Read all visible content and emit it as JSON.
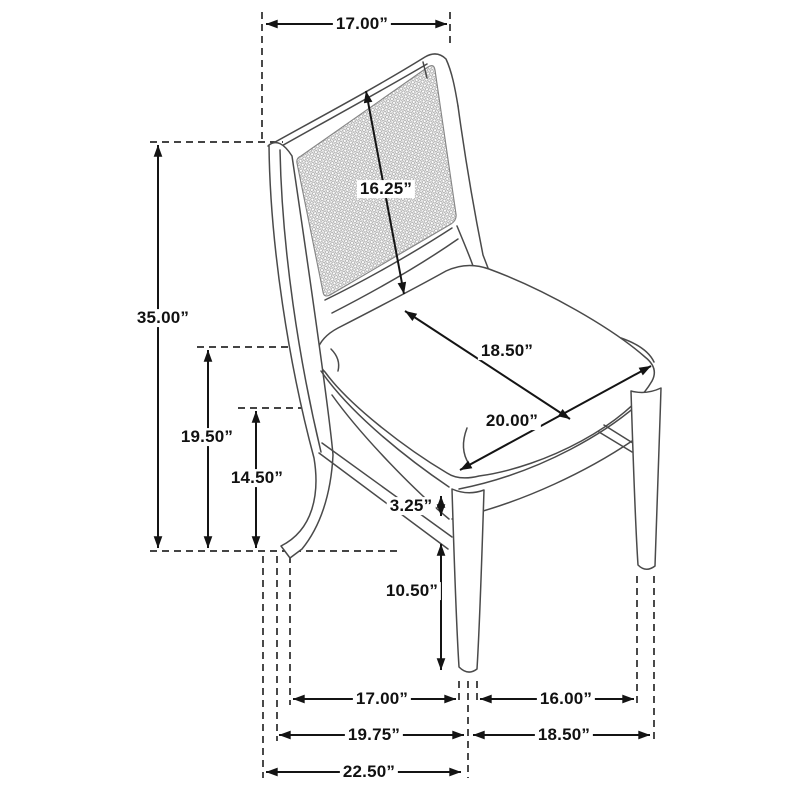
{
  "diagram": {
    "unit": "inches",
    "colors": {
      "dimension_line": "#141414",
      "chair_line": "#4a4a4a",
      "cane_mesh": "#8f8f8f",
      "background": "#ffffff"
    },
    "dims": {
      "back_width": "17.00”",
      "overall_height": "35.00”",
      "back_panel_height": "16.25”",
      "seat_depth": "18.50”",
      "seat_width": "20.00”",
      "seat_height": "19.50”",
      "frame_height": "14.50”",
      "seat_rail_thickness": "3.25”",
      "leg_height": "10.50”",
      "leg_span_side": "17.00”",
      "front_leg_inner_width": "16.00”",
      "base_depth": "19.75”",
      "base_width": "18.50”",
      "overall_depth": "22.50”"
    }
  }
}
